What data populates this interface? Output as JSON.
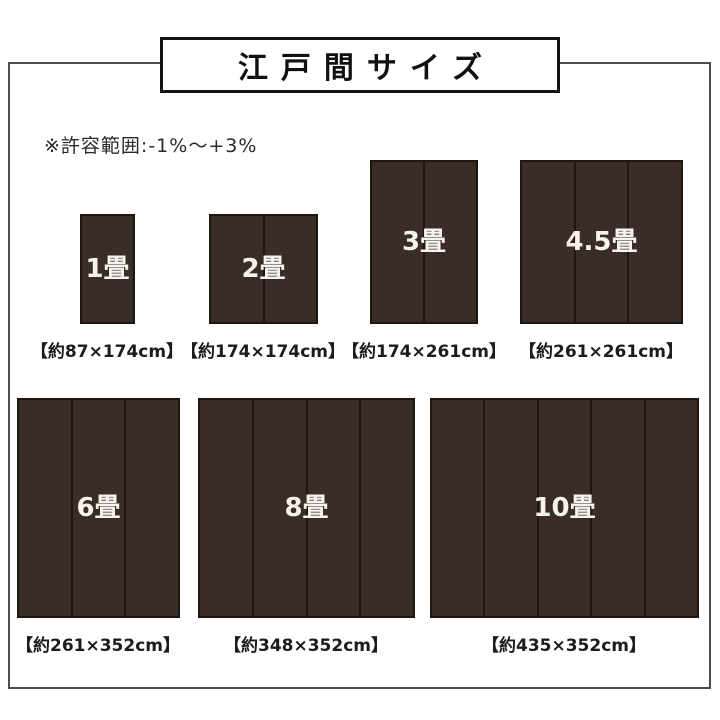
{
  "title": {
    "text": "江戸間サイズ"
  },
  "note": {
    "text": "※許容範囲:-1%〜+3%"
  },
  "mats": [
    {
      "label": "1畳",
      "dimensions": "【約87×174cm】",
      "panels": 1,
      "box": {
        "x": 80,
        "y": 214,
        "w": 55,
        "h": 110
      },
      "dim_label": {
        "cx": 107,
        "y": 337
      }
    },
    {
      "label": "2畳",
      "dimensions": "【約174×174cm】",
      "panels": 2,
      "box": {
        "x": 209,
        "y": 214,
        "w": 109,
        "h": 110
      },
      "dim_label": {
        "cx": 263,
        "y": 337
      }
    },
    {
      "label": "3畳",
      "dimensions": "【約174×261cm】",
      "panels": 2,
      "box": {
        "x": 370,
        "y": 160,
        "w": 108,
        "h": 164
      },
      "dim_label": {
        "cx": 424,
        "y": 337
      }
    },
    {
      "label": "4.5畳",
      "dimensions": "【約261×261cm】",
      "panels": 3,
      "box": {
        "x": 520,
        "y": 160,
        "w": 163,
        "h": 164
      },
      "dim_label": {
        "cx": 601,
        "y": 337
      }
    },
    {
      "label": "6畳",
      "dimensions": "【約261×352cm】",
      "panels": 3,
      "box": {
        "x": 17,
        "y": 398,
        "w": 163,
        "h": 220
      },
      "dim_label": {
        "cx": 98,
        "y": 631
      }
    },
    {
      "label": "8畳",
      "dimensions": "【約348×352cm】",
      "panels": 4,
      "box": {
        "x": 198,
        "y": 398,
        "w": 217,
        "h": 220
      },
      "dim_label": {
        "cx": 306,
        "y": 631
      }
    },
    {
      "label": "10畳",
      "dimensions": "【約435×352cm】",
      "panels": 5,
      "box": {
        "x": 430,
        "y": 398,
        "w": 269,
        "h": 220
      },
      "dim_label": {
        "cx": 564,
        "y": 631
      }
    }
  ],
  "colors": {
    "mat_fill": "#3a2c26",
    "mat_border": "#20150f",
    "divider": "#20150f",
    "frame_border": "#4c4c4c",
    "title_border": "#141414",
    "text": "#1c1c1c",
    "mat_label": "#f6f3ef"
  }
}
